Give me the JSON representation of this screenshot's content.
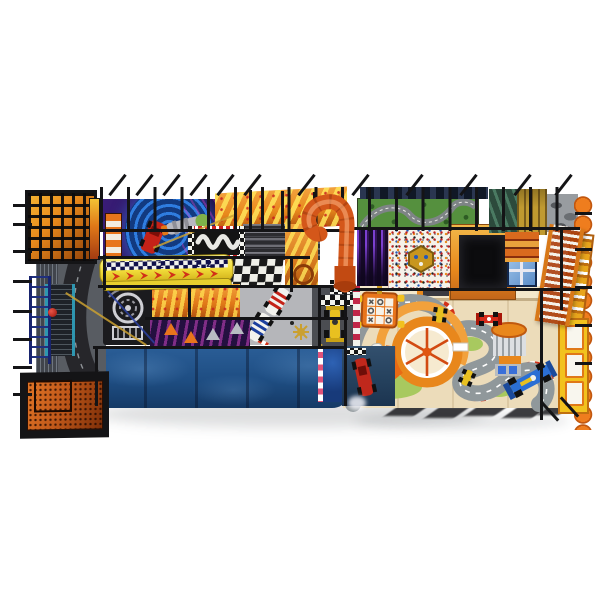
{
  "image": {
    "type": "product-photo",
    "subject": "Car-racing themed indoor soft-play playground structure, elevated top view on white background",
    "background_color": "#ffffff"
  },
  "palette": {
    "frame-black": "#141416",
    "cage-orange": "#e8891c",
    "slide-yellow": "#f2dd3a",
    "tube-orange": "#d4571a",
    "wall-blue": "#1e4d82",
    "floor-cream": "#ecdcba",
    "track-gray": "#90989b",
    "curb-red": "#d23018",
    "grass-green": "#a8c95f",
    "panel-purple": "#3a1d78",
    "mat-green": "#55903e",
    "pit-black": "#0c0c0e",
    "scallop-orange": "#ef7d1e",
    "ladder-orange": "#d87818",
    "container-orange": "#c2591a",
    "car-red": "#d42a1a",
    "car-blue": "#2b6fd4",
    "kart-yellow": "#e8c020"
  },
  "slide": {
    "lane_numbers": [
      "2",
      "1",
      "2"
    ]
  },
  "parts": {
    "cage": "black climbing net cage with orange interior",
    "purple_panel": "purple panel with blue spiral, race car and rocket art",
    "yellow_slide": "yellow wave slide with checkered lanes and red chevrons",
    "s_track_panel": "black panel with white S-curve track",
    "checker_floor": "black and white checkered floor pad",
    "tube_slide": "orange spiral tube slide",
    "green_mat": "green race-track play mat",
    "confetti_panel": "confetti ball-pit panel with hexagon badge",
    "foam_pit": "black foam pit with orange frame",
    "race_floor": "cream karting floor with winding gray track, curbs and cars",
    "carousel": "orange spinner wheel",
    "blue_wall": "blue textured front wall",
    "container": "orange perforated container panel",
    "ladder": "orange ladder ramp with white rungs",
    "scallop_edge": "orange scalloped right edge"
  }
}
